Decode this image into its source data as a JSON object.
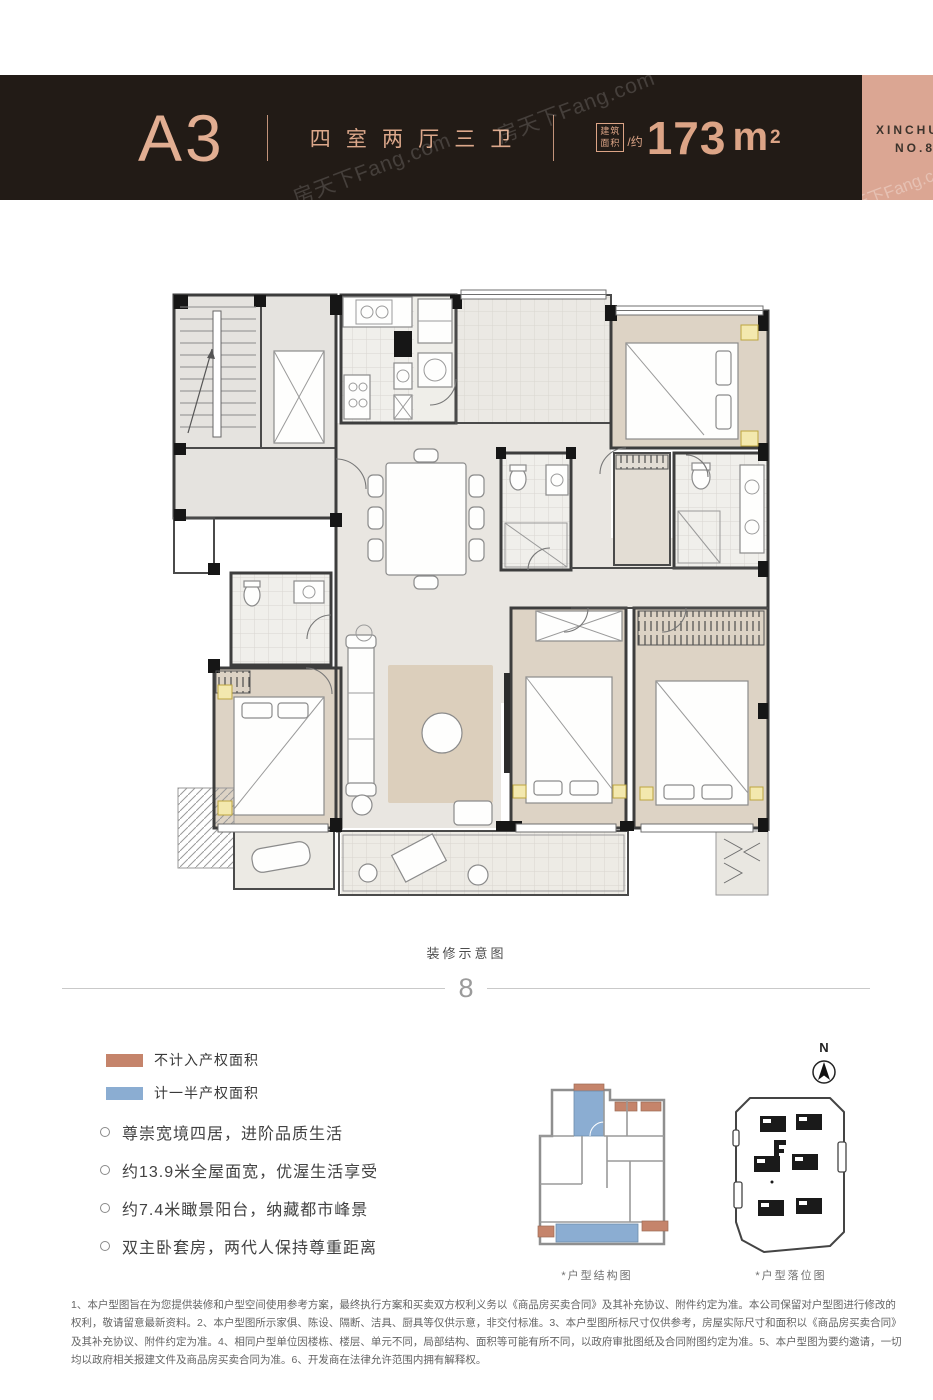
{
  "header": {
    "unit_name": "A3",
    "layout_label": "四室两厅三卫",
    "area_badge_top": "建筑",
    "area_badge_bottom": "面积",
    "area_approx": "/约",
    "area_value": "173",
    "area_unit": "m",
    "area_sup": "2",
    "band_line1": "XINCHU",
    "band_line2": "NO.8"
  },
  "watermark": {
    "text": "房天下Fang.com"
  },
  "plan": {
    "caption": "装修示意图"
  },
  "divider": {
    "ornament": "8"
  },
  "legend": {
    "items": [
      {
        "label": "不计入产权面积",
        "color": "#c5846b"
      },
      {
        "label": "计一半产权面积",
        "color": "#8badd2"
      }
    ]
  },
  "highlights": [
    "尊崇宽境四居，进阶品质生活",
    "约13.9米全屋面宽，优渥生活享受",
    "约7.4米瞰景阳台，纳藏都市峰景",
    "双主卧套房，两代人保持尊重距离"
  ],
  "diagrams": {
    "structure_label": "*户型结构图",
    "position_label": "*户型落位图",
    "compass_label": "N"
  },
  "disclaimer": {
    "lines": [
      "1、本户型图旨在为您提供装修和户型空间使用参考方案，最终执行方案和买卖双方权利义务以《商品房买卖合同》及其补充协议、附件约定为准。本公司保留对户型图进行修改的",
      "权利，敬请留意最新资料。2、本户型图所示家俱、陈设、隔断、洁具、厨具等仅供示意，非交付标准。3、本户型图所标尺寸仅供参考，房屋实际尺寸和面积以《商品房买卖合同》",
      "及其补充协议、附件约定为准。4、相同户型单位因楼栋、楼层、单元不同，局部结构、面积等可能有所不同，以政府审批图纸及合同附图约定为准。5、本户型图为要约邀请，一切",
      "均以政府相关报建文件及商品房买卖合同为准。6、开发商在法律允许范围内拥有解释权。"
    ]
  },
  "colors": {
    "header_bg": "#221b16",
    "accent_copper": "#dca486",
    "band_pink": "#dba693",
    "legend_salmon": "#c5846b",
    "legend_blue": "#8badd2"
  }
}
